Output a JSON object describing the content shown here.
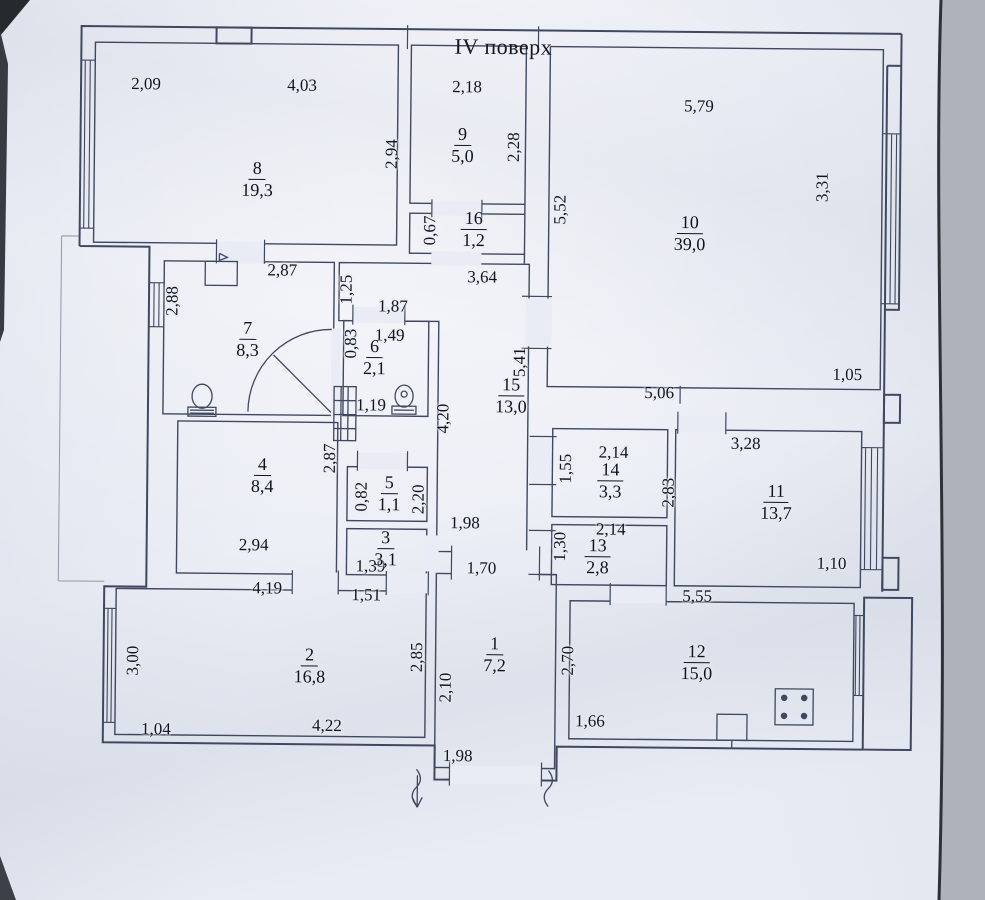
{
  "page": {
    "title": "IV поверх"
  },
  "colors": {
    "paper": "#e9ecf4",
    "ink": "#3f4860",
    "text": "#12151d",
    "photo_edge": "#2e3138"
  },
  "plan": {
    "rooms": [
      {
        "no": "1",
        "area": "7,2",
        "x": 497,
        "y": 655
      },
      {
        "no": "2",
        "area": "16,8",
        "x": 312,
        "y": 668
      },
      {
        "no": "3",
        "area": "3,1",
        "x": 387,
        "y": 550
      },
      {
        "no": "4",
        "area": "8,4",
        "x": 263,
        "y": 478
      },
      {
        "no": "5",
        "area": "1,1",
        "x": 390,
        "y": 495
      },
      {
        "no": "6",
        "area": "2,1",
        "x": 374,
        "y": 359
      },
      {
        "no": "7",
        "area": "8,3",
        "x": 247,
        "y": 342
      },
      {
        "no": "8",
        "area": "19,3",
        "x": 255,
        "y": 182
      },
      {
        "no": "9",
        "area": "5,0",
        "x": 460,
        "y": 146
      },
      {
        "no": "10",
        "area": "39,0",
        "x": 688,
        "y": 232
      },
      {
        "no": "11",
        "area": "13,7",
        "x": 777,
        "y": 500
      },
      {
        "no": "12",
        "area": "15,0",
        "x": 699,
        "y": 661
      },
      {
        "no": "13",
        "area": "2,8",
        "x": 599,
        "y": 556
      },
      {
        "no": "14",
        "area": "3,3",
        "x": 611,
        "y": 480
      },
      {
        "no": "15",
        "area": "13,0",
        "x": 511,
        "y": 396
      },
      {
        "no": "16",
        "area": "1,2",
        "x": 472,
        "y": 230
      }
    ],
    "dims": [
      {
        "t": "2,09",
        "x": 143,
        "y": 87,
        "v": false
      },
      {
        "t": "4,03",
        "x": 299,
        "y": 87,
        "v": false
      },
      {
        "t": "2,18",
        "x": 464,
        "y": 87,
        "v": false
      },
      {
        "t": "5,79",
        "x": 696,
        "y": 104,
        "v": false
      },
      {
        "t": "2,87",
        "x": 281,
        "y": 272,
        "v": false
      },
      {
        "t": "1,87",
        "x": 392,
        "y": 307,
        "v": false
      },
      {
        "t": "1,49",
        "x": 389,
        "y": 336,
        "v": false
      },
      {
        "t": "3,64",
        "x": 481,
        "y": 277,
        "v": false
      },
      {
        "t": "1,19",
        "x": 371,
        "y": 406,
        "v": false
      },
      {
        "t": "5,06",
        "x": 659,
        "y": 391,
        "v": false
      },
      {
        "t": "1,05",
        "x": 847,
        "y": 371,
        "v": false
      },
      {
        "t": "3,28",
        "x": 746,
        "y": 441,
        "v": false
      },
      {
        "t": "2,14",
        "x": 614,
        "y": 451,
        "v": false
      },
      {
        "t": "2,14",
        "x": 612,
        "y": 528,
        "v": false
      },
      {
        "t": "1,10",
        "x": 833,
        "y": 560,
        "v": false
      },
      {
        "t": "5,55",
        "x": 699,
        "y": 594,
        "v": false
      },
      {
        "t": "4,19",
        "x": 269,
        "y": 590,
        "v": false
      },
      {
        "t": "1,39",
        "x": 372,
        "y": 567,
        "v": false
      },
      {
        "t": "1,51",
        "x": 368,
        "y": 596,
        "v": false
      },
      {
        "t": "2,94",
        "x": 255,
        "y": 547,
        "v": false
      },
      {
        "t": "1,98",
        "x": 466,
        "y": 523,
        "v": false
      },
      {
        "t": "1,70",
        "x": 483,
        "y": 568,
        "v": false
      },
      {
        "t": "1,66",
        "x": 593,
        "y": 720,
        "v": false
      },
      {
        "t": "4,22",
        "x": 330,
        "y": 727,
        "v": false
      },
      {
        "t": "1,04",
        "x": 159,
        "y": 732,
        "v": false
      },
      {
        "t": "1,98",
        "x": 461,
        "y": 756,
        "v": false
      },
      {
        "t": "2,94",
        "x": 389,
        "y": 155,
        "v": true
      },
      {
        "t": "2,28",
        "x": 511,
        "y": 147,
        "v": true
      },
      {
        "t": "0,67",
        "x": 428,
        "y": 231,
        "v": true
      },
      {
        "t": "5,52",
        "x": 558,
        "y": 209,
        "v": true
      },
      {
        "t": "3,31",
        "x": 820,
        "y": 184,
        "v": true
      },
      {
        "t": "2,88",
        "x": 171,
        "y": 304,
        "v": true
      },
      {
        "t": "1,25",
        "x": 345,
        "y": 291,
        "v": true
      },
      {
        "t": "0,83",
        "x": 350,
        "y": 345,
        "v": true
      },
      {
        "t": "4,20",
        "x": 443,
        "y": 419,
        "v": true
      },
      {
        "t": "5,41",
        "x": 519,
        "y": 362,
        "v": true
      },
      {
        "t": "0,82",
        "x": 362,
        "y": 498,
        "v": true
      },
      {
        "t": "2,87",
        "x": 330,
        "y": 460,
        "v": true
      },
      {
        "t": "2,20",
        "x": 419,
        "y": 500,
        "v": true
      },
      {
        "t": "1,55",
        "x": 566,
        "y": 468,
        "v": true
      },
      {
        "t": "1,30",
        "x": 561,
        "y": 546,
        "v": true
      },
      {
        "t": "2,83",
        "x": 669,
        "y": 491,
        "v": true
      },
      {
        "t": "3,00",
        "x": 135,
        "y": 664,
        "v": true
      },
      {
        "t": "2,85",
        "x": 419,
        "y": 658,
        "v": true
      },
      {
        "t": "2,10",
        "x": 448,
        "y": 688,
        "v": true
      },
      {
        "t": "2,70",
        "x": 570,
        "y": 660,
        "v": true
      }
    ]
  }
}
